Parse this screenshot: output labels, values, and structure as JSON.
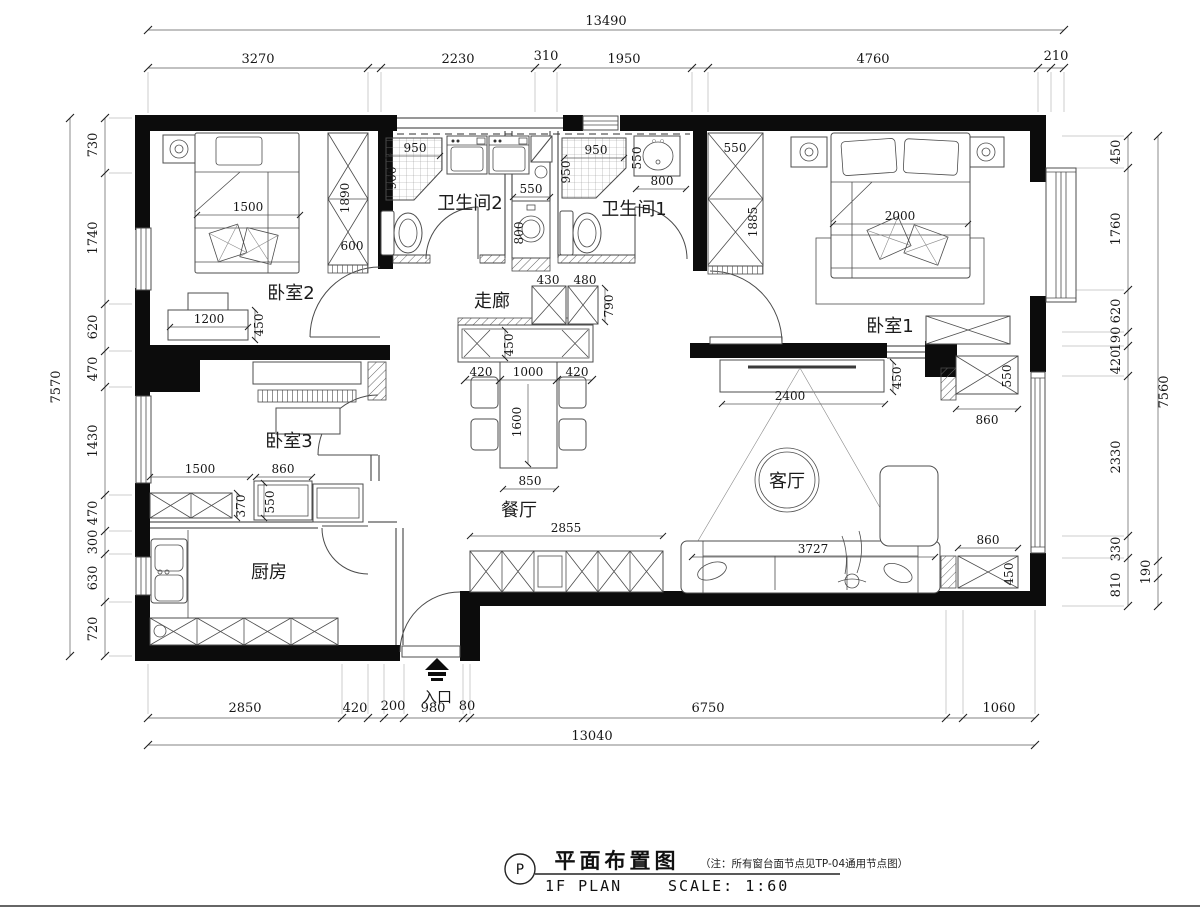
{
  "rooms": {
    "bedroom2": "卧室2",
    "bathroom2": "卫生间2",
    "corridor": "走廊",
    "bathroom1": "卫生间1",
    "bedroom1": "卧室1",
    "bedroom3": "卧室3",
    "dining": "餐厅",
    "living": "客厅",
    "kitchen": "厨房",
    "entrance": "入口"
  },
  "dims": {
    "top": {
      "total": "13490",
      "segs": [
        "3270",
        "2230",
        "310",
        "1950",
        "4760",
        "210"
      ]
    },
    "left": {
      "total": "7570",
      "segs": [
        "730",
        "1740",
        "620",
        "470",
        "1430",
        "470",
        "300",
        "630",
        "720"
      ]
    },
    "right": {
      "total": "7560",
      "extra": "190",
      "segs": [
        "450",
        "1760",
        "620",
        "190",
        "420",
        "2330",
        "330",
        "810"
      ]
    },
    "bottom": {
      "total": "13040",
      "segs": [
        "2850",
        "420",
        "200",
        "980",
        "80",
        "6750",
        "1060"
      ]
    }
  },
  "furniture_dims": {
    "bedroom2": {
      "bed_w": "1500",
      "wardrobe_h": "1890",
      "wardrobe_w": "600",
      "dresser_w": "1200",
      "dresser_d": "450"
    },
    "bathroom2": {
      "shower_w": "950",
      "shower_d": "900",
      "vanity_w": "550",
      "vanity_d": "800"
    },
    "bathroom1": {
      "shower_w": "950",
      "shower_d": "950",
      "basin_w": "550",
      "basin_d": "800"
    },
    "corridor": {
      "cab1_w": "430",
      "cab2_w": "480",
      "cab_d": "790"
    },
    "bedroom1": {
      "wardrobe_w": "550",
      "wardrobe_h": "1885",
      "bed_w": "2000"
    },
    "bedroom3": {
      "span_w": "1500",
      "cab_w": "860",
      "cab_d1": "370",
      "cab_d2": "550"
    },
    "dining": {
      "sideboard_d": "450",
      "chair_left": "420",
      "table_w": "1000",
      "chair_right": "420",
      "table_l": "1600",
      "table_end": "850",
      "cabinets_w": "2855"
    },
    "living": {
      "tv_wall_w": "2400",
      "tv_d": "450",
      "sofa_w": "3727",
      "cab_ne_w": "860",
      "cab_ne_d": "550",
      "cab_se_w": "860",
      "cab_se_d": "450"
    }
  },
  "title_block": {
    "marker": "P",
    "title": "平面布置图",
    "note": "（注：所有窗台面节点见TP-04通用节点图）",
    "plan_en": "1F PLAN",
    "scale": "SCALE: 1:60"
  }
}
